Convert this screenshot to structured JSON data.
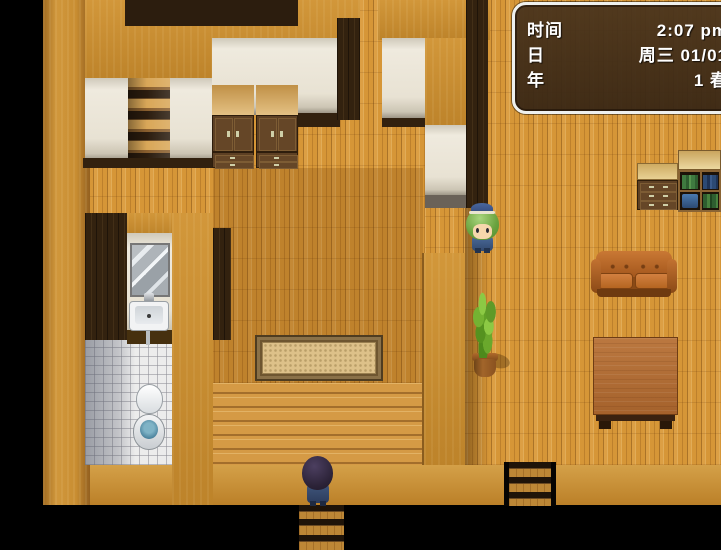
{
  "hud": {
    "rows": [
      {
        "label": "时间",
        "value": "2:07 pm"
      },
      {
        "label": "日",
        "value": "周三 01/01"
      },
      {
        "label": "年",
        "value": "1 春"
      }
    ]
  },
  "palette": {
    "background": "#000000",
    "floor": "#d69637",
    "floor_dark_overlay": "rgba(100,50,0,0.20)",
    "wall_top": "#c98f33",
    "wall_front_cream": "#ece6d8",
    "dark_wall": "#33220f",
    "bathroom_tile": "#ececec",
    "toilet_water": "#4f86a0",
    "couch_leather": "#bf6b27",
    "table_wood": "#b4703a",
    "plant_green": "#6fb02a",
    "hud_background": "#46301a",
    "hud_border": "#eef0ee",
    "hud_text": "#ffffff"
  },
  "scene": {
    "objects": [
      "staircase-up",
      "wardrobe",
      "wardrobe",
      "mirror",
      "sink",
      "toilet",
      "rug",
      "wood-deck",
      "potted-plant",
      "couch",
      "dresser",
      "bookshelf",
      "table",
      "ladder-down",
      "ladder-down",
      "player-character",
      "npc-character"
    ]
  }
}
